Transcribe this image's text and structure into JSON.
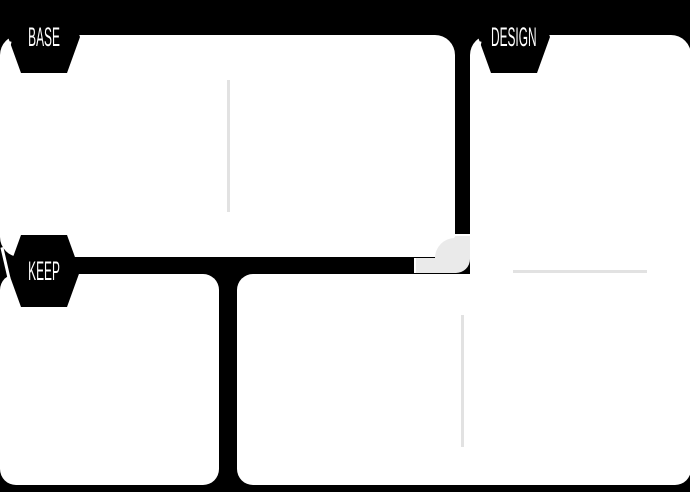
{
  "badges": {
    "base": {
      "label": "BASE"
    },
    "design": {
      "label": "DESIGN"
    },
    "keep": {
      "label": "KEEP"
    }
  },
  "colors": {
    "background": "#000000",
    "panel": "#ffffff",
    "pipe_active": "#000000",
    "pipe_inactive": "#eaeaea",
    "guide_line": "#e2e2e2",
    "badge_text": "#ffffff"
  }
}
